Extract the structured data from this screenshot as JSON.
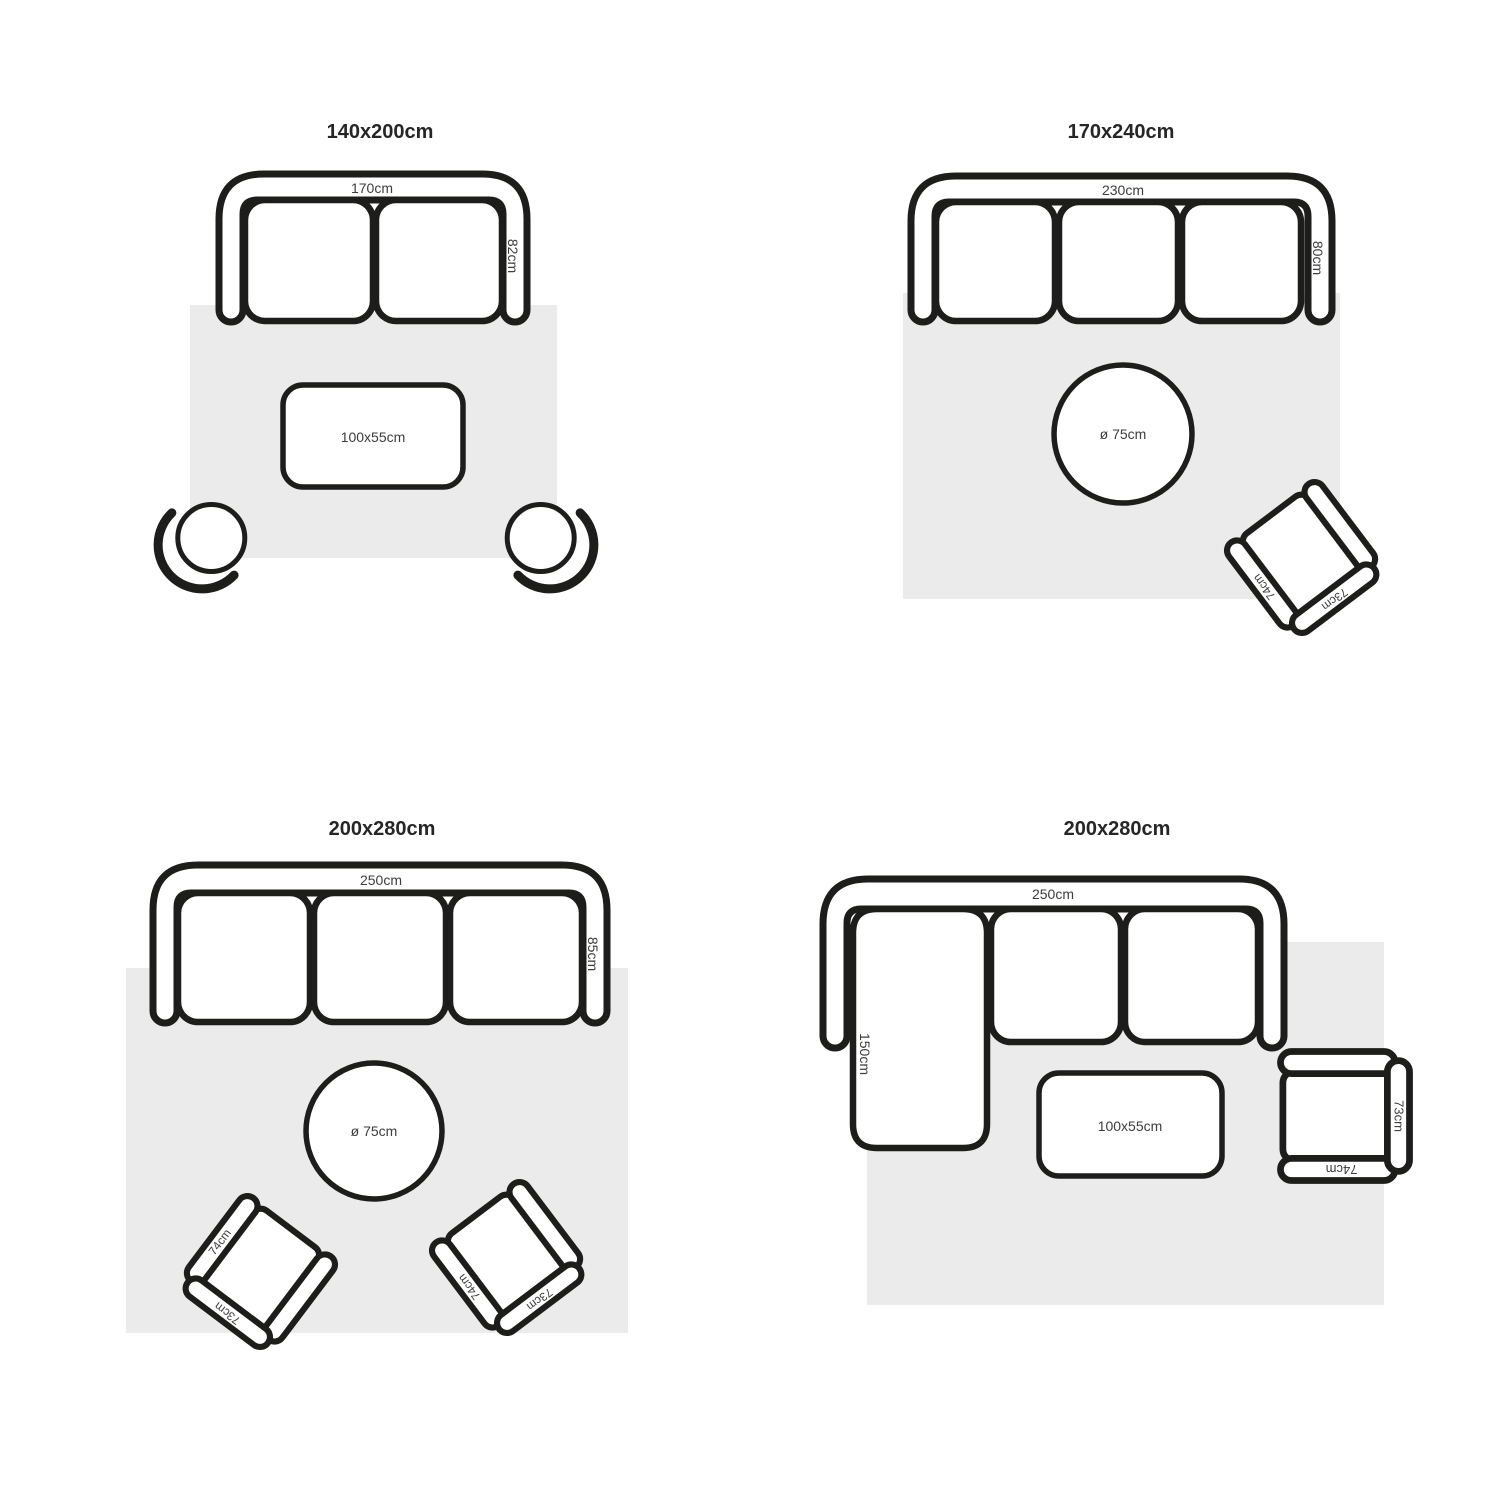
{
  "figure": "rug size placement guide",
  "colors": {
    "background": "#ffffff",
    "line": "#1d1d1b",
    "rug": "#ebebeb",
    "title_text": "#262626",
    "label_text": "#3d3d3d"
  },
  "panels": [
    {
      "title": "140x200cm",
      "sofa": {
        "width": "170cm",
        "depth": "82cm"
      },
      "coffee_table": "100x55cm"
    },
    {
      "title": "170x240cm",
      "sofa": {
        "width": "230cm",
        "depth": "80cm"
      },
      "round_table": "ø 75cm",
      "armchair": {
        "arm": "74cm",
        "back": "73cm"
      }
    },
    {
      "title": "200x280cm",
      "sofa": {
        "width": "250cm",
        "depth": "85cm"
      },
      "round_table": "ø 75cm",
      "armchair_left": {
        "arm": "74cm",
        "back": "73cm"
      },
      "armchair_right": {
        "arm": "74cm",
        "back": "73cm"
      }
    },
    {
      "title": "200x280cm",
      "sofa": {
        "width": "250cm",
        "chaise": "150cm"
      },
      "coffee_table": "100x55cm",
      "armchair": {
        "arm": "74cm",
        "back": "73cm"
      }
    }
  ]
}
